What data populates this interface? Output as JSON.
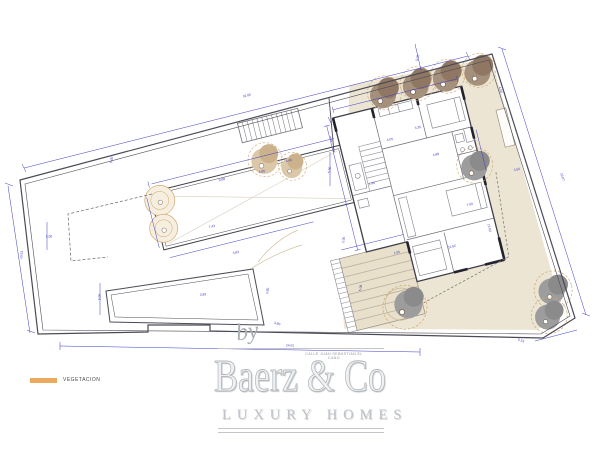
{
  "page": {
    "width": 600,
    "height": 451,
    "background": "#ffffff"
  },
  "legend": {
    "swatch_color": "#eba95e",
    "label": "VEGETACION"
  },
  "branding": {
    "by_label": "by",
    "company_name": "Baerz & Co",
    "tagline": "LUXURY HOMES",
    "address_line": "CALLE JUAN SEBASTIAN EL CANO"
  },
  "plan": {
    "colors": {
      "terrace_beige": "#ece5d3",
      "steps_beige": "#e8e0ca",
      "tree_brown": "#a5907c",
      "tree_brown_dark": "#8f7763",
      "tree_gray": "#9d9d9d",
      "tree_outline_tan": "#cfa86f",
      "dimension_blue": "#3b3bc4",
      "wall_dark": "#3f3f4a"
    },
    "dimension_labels": [
      {
        "text": "32.60",
        "x": 247,
        "y": 96,
        "r": -14
      },
      {
        "text": "5.00",
        "x": 112,
        "y": 160,
        "r": -80
      },
      {
        "text": "10.53",
        "x": 22,
        "y": 255,
        "r": -82
      },
      {
        "text": "5.00",
        "x": 49,
        "y": 237,
        "r": -3
      },
      {
        "text": "5.00",
        "x": 100,
        "y": 297,
        "r": -88
      },
      {
        "text": "24.81",
        "x": 290,
        "y": 346,
        "r": 1
      },
      {
        "text": "5.23",
        "x": 521,
        "y": 341,
        "r": 18
      },
      {
        "text": "19.07",
        "x": 562,
        "y": 177,
        "r": 73
      },
      {
        "text": "13.62",
        "x": 489,
        "y": 228,
        "r": 76
      },
      {
        "text": "3.50",
        "x": 517,
        "y": 170,
        "r": -14
      },
      {
        "text": "7.00",
        "x": 470,
        "y": 205,
        "r": -14
      },
      {
        "text": "5.00",
        "x": 330,
        "y": 170,
        "r": -80
      },
      {
        "text": "9.88",
        "x": 222,
        "y": 180,
        "r": -13
      },
      {
        "text": "7.43",
        "x": 212,
        "y": 227,
        "r": -13
      },
      {
        "text": "3.83",
        "x": 236,
        "y": 253,
        "r": -13
      },
      {
        "text": "4.40",
        "x": 289,
        "y": 161,
        "r": -13
      },
      {
        "text": "4.85",
        "x": 262,
        "y": 172,
        "r": -13
      },
      {
        "text": "3.83",
        "x": 203,
        "y": 295,
        "r": -5
      },
      {
        "text": "4.80",
        "x": 268,
        "y": 291,
        "r": -83
      },
      {
        "text": "3.80",
        "x": 277,
        "y": 324,
        "r": 14
      },
      {
        "text": "5.08",
        "x": 361,
        "y": 288,
        "r": -80
      },
      {
        "text": "2.00",
        "x": 344,
        "y": 240,
        "r": -80
      },
      {
        "text": "11.62",
        "x": 452,
        "y": 247,
        "r": -13
      },
      {
        "text": "1.90",
        "x": 397,
        "y": 253,
        "r": -13
      },
      {
        "text": "4.88",
        "x": 436,
        "y": 155,
        "r": -13
      },
      {
        "text": "4.05",
        "x": 390,
        "y": 140,
        "r": -13
      },
      {
        "text": "3.35",
        "x": 418,
        "y": 128,
        "r": -13
      },
      {
        "text": "1.45",
        "x": 372,
        "y": 184,
        "r": -13
      },
      {
        "text": "5.00",
        "x": 418,
        "y": 58,
        "r": -76
      },
      {
        "text": "4.00",
        "x": 500,
        "y": 90,
        "r": 73
      }
    ]
  }
}
